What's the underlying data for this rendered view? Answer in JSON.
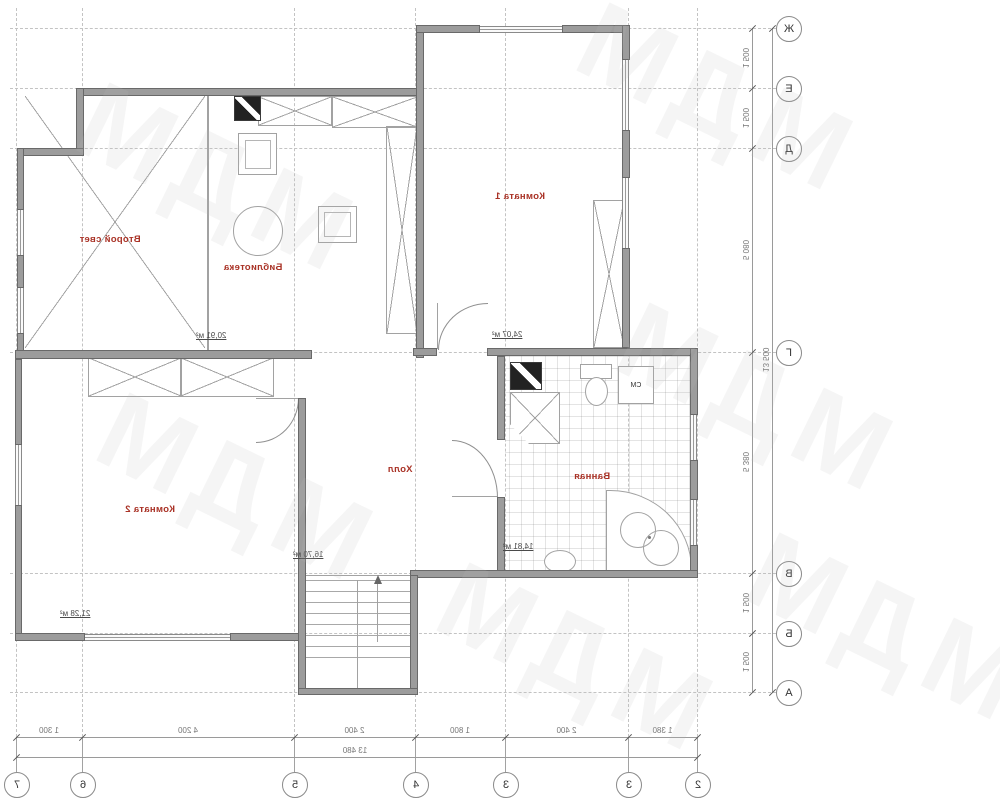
{
  "plan": {
    "rooms": [
      {
        "name": "Второй свет",
        "area": ""
      },
      {
        "name": "Библиотека",
        "area": "20,91 м²"
      },
      {
        "name": "Комната 1",
        "area": "24,07 м²"
      },
      {
        "name": "Комната 2",
        "area": "21,28 м²"
      },
      {
        "name": "Холл",
        "area": "16,70 м²"
      },
      {
        "name": "Ванная",
        "area": "14,81 м²"
      }
    ],
    "washing_machine_label": "СМ"
  },
  "axes": {
    "letters": [
      "Ж",
      "Е",
      "Д",
      "Г",
      "В",
      "Б",
      "А"
    ],
    "numbers": [
      "7",
      "6",
      "5",
      "4",
      "3",
      "3",
      "2"
    ]
  },
  "dimensions": {
    "right": [
      "1 500",
      "1 500",
      "5 080",
      "5 380",
      "1 500",
      "1 500"
    ],
    "right_overall": "13 500",
    "bottom": [
      "1 300",
      "4 200",
      "2 400",
      "1 800",
      "2 400",
      "1 380"
    ],
    "bottom_overall": "13 480"
  },
  "watermark": "МДМ",
  "colors": {
    "room_label_red": "#a93226",
    "wall_gray": "#9c9c9c",
    "dimension_text": "#777777"
  }
}
